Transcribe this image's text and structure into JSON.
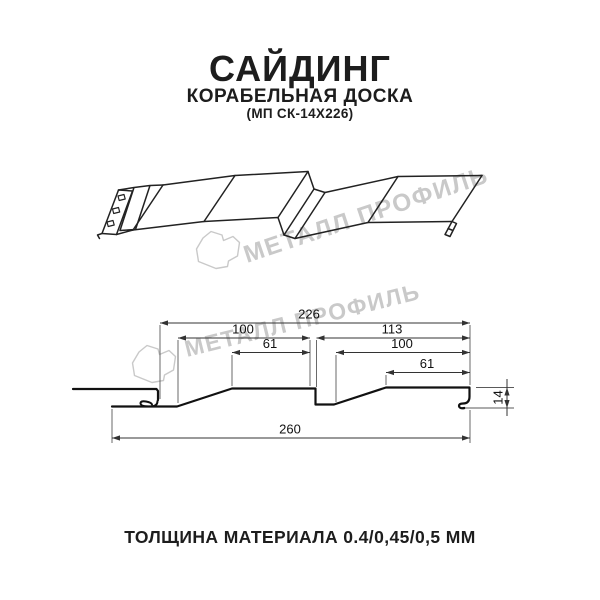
{
  "header": {
    "title": "САЙДИНГ",
    "subtitle": "КОРАБЕЛЬНАЯ ДОСКА",
    "code": "(МП СК-14Х226)"
  },
  "watermark": {
    "text": "МЕТАЛЛ ПРОФИЛЬ",
    "color": "#c9c9c9"
  },
  "section": {
    "dims": {
      "top_width": "226",
      "upper_left": "100",
      "upper_right": "113",
      "mid_left": "61",
      "mid_right": "100",
      "lower_right": "61",
      "overall_bottom": "260",
      "height": "14"
    }
  },
  "footer": {
    "thickness": "ТОЛЩИНА МАТЕРИАЛА 0.4/0,45/0,5 ММ"
  }
}
